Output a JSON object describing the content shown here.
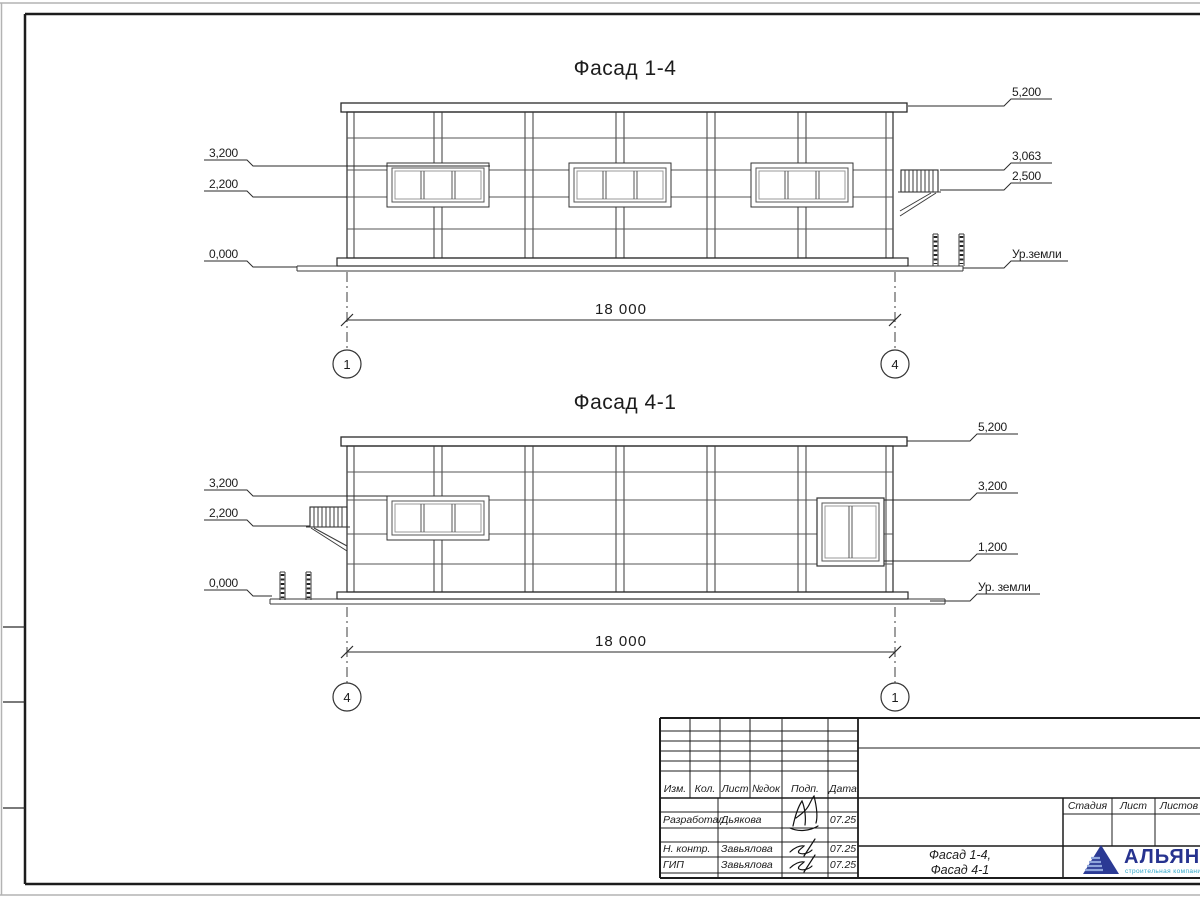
{
  "sheet": {
    "facade1": {
      "title": "Фасад 1-4",
      "dimension": "18 000",
      "axis_left": "1",
      "axis_right": "4",
      "marks_left": [
        "3,200",
        "2,200",
        "0,000"
      ],
      "marks_right": [
        "5,200",
        "3,063",
        "2,500"
      ],
      "ground_label": "Ур.земли"
    },
    "facade2": {
      "title": "Фасад 4-1",
      "dimension": "18 000",
      "axis_left": "4",
      "axis_right": "1",
      "marks_left": [
        "3,200",
        "2,200",
        "0,000"
      ],
      "marks_right": [
        "5,200",
        "3,200",
        "1,200"
      ],
      "ground_label": "Ур. земли"
    },
    "titleblock": {
      "columns": [
        "Изм.",
        "Кол.",
        "Лист",
        "№док",
        "Подп.",
        "Дата"
      ],
      "rows": [
        {
          "role": "Разработал",
          "name": "Дьякова",
          "date": "07.25"
        },
        {
          "role": "Н. контр.",
          "name": "Завьялова",
          "date": "07.25"
        },
        {
          "role": "ГИП",
          "name": "Завьялова",
          "date": "07.25"
        }
      ],
      "doc_name": [
        "Фасад 1-4,",
        "Фасад 4-1"
      ],
      "stage_columns": [
        "Стадия",
        "Лист",
        "Листов"
      ],
      "logo_text": "АЛЬЯНС",
      "logo_subtitle": "строительная компания",
      "logo_color": "#27338f",
      "logo_subtitle_color": "#2fa6c8"
    }
  }
}
